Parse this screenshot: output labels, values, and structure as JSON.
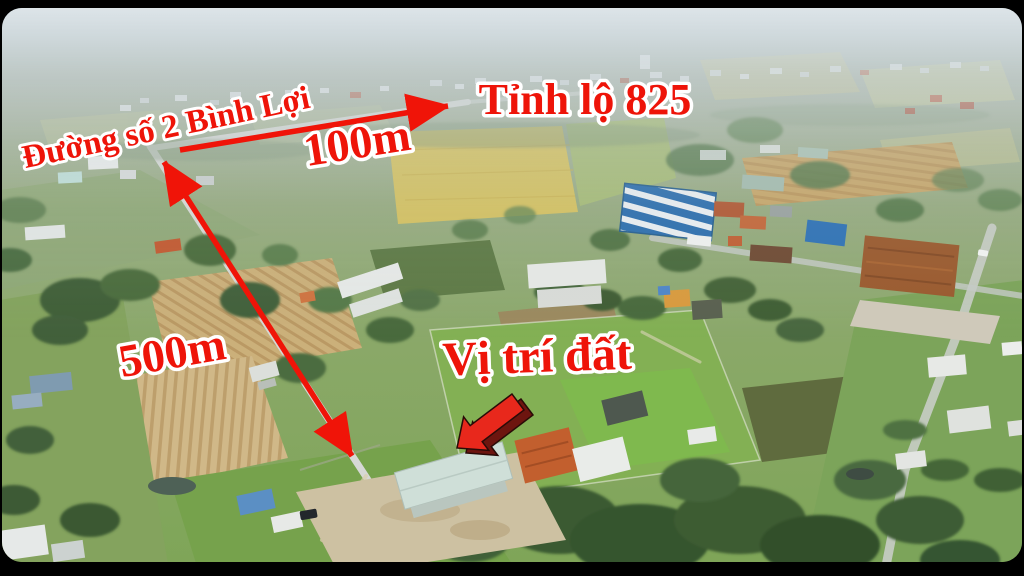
{
  "annotations": {
    "road_name": "Đường số 2 Bình Lợi",
    "destination_road": "Tỉnh lộ 825",
    "distance_100m": "100m",
    "distance_500m": "500m",
    "land_location": "Vị trí đất"
  },
  "colors": {
    "annotation_red": "#ee1409",
    "text_outline": "#ffffff",
    "arrow_red": "#f01408",
    "arrow_3d_face": "#e8281c",
    "arrow_3d_shadow": "#6d150f",
    "frame_background": "#000000"
  }
}
